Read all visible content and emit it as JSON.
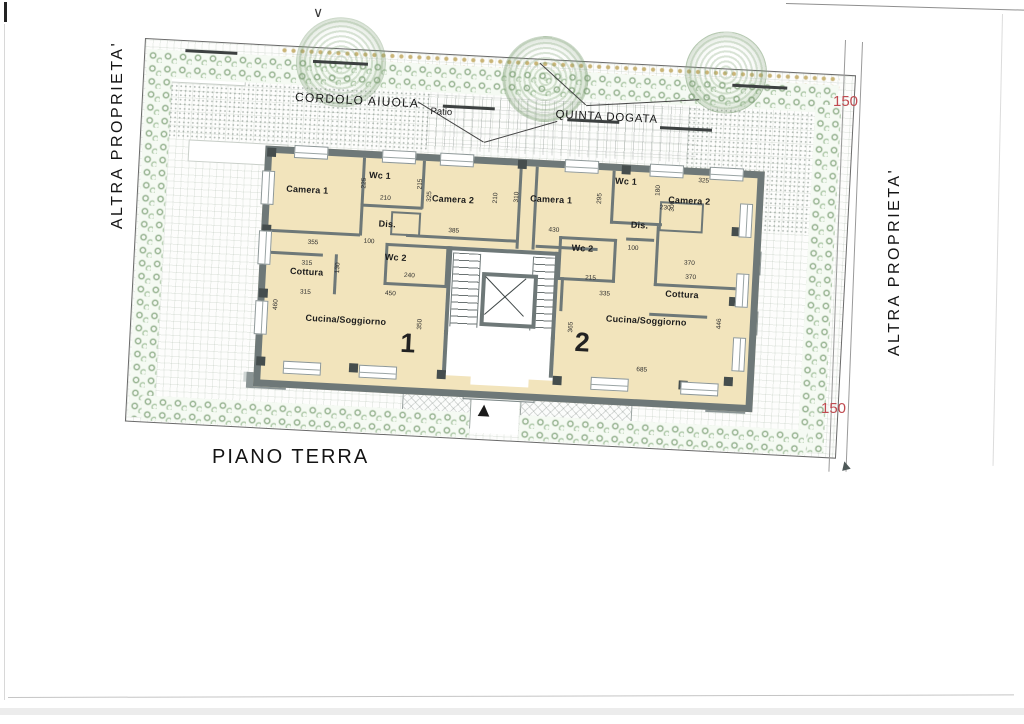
{
  "drawing_title": "PIANO TERRA",
  "site": {
    "left_property_label": "ALTRA PROPRIETA'",
    "right_property_label": "ALTRA PROPRIETA'",
    "flowerbed_label": "CORDOLO AIUOLA",
    "patio_label": "Patio",
    "hedge_label": "QUINTA DOGATA",
    "setback_dim_top": "150",
    "setback_dim_bottom": "150"
  },
  "building": {
    "apartment_numbers": [
      {
        "text": "1",
        "x": 138,
        "y": 168
      },
      {
        "text": "2",
        "x": 312,
        "y": 158
      }
    ],
    "room_labels": [
      {
        "text": "Camera 1",
        "x": 16,
        "y": 30
      },
      {
        "text": "Wc 1",
        "x": 98,
        "y": 12
      },
      {
        "text": "Camera 2",
        "x": 162,
        "y": 32
      },
      {
        "text": "Dis.",
        "x": 110,
        "y": 60
      },
      {
        "text": "Wc 2",
        "x": 118,
        "y": 93
      },
      {
        "text": "Cottura",
        "x": 24,
        "y": 112
      },
      {
        "text": "Cucina/Soggiorno",
        "x": 42,
        "y": 158
      },
      {
        "text": "Camera 1",
        "x": 260,
        "y": 27
      },
      {
        "text": "Wc 1",
        "x": 344,
        "y": 5
      },
      {
        "text": "Camera 2",
        "x": 398,
        "y": 21
      },
      {
        "text": "Dis.",
        "x": 362,
        "y": 48
      },
      {
        "text": "Wc 2",
        "x": 304,
        "y": 74
      },
      {
        "text": "Cottura",
        "x": 400,
        "y": 115
      },
      {
        "text": "Cucina/Soggiorno",
        "x": 342,
        "y": 143
      }
    ],
    "dimension_labels": [
      {
        "t": "355",
        "x": 40,
        "y": 84
      },
      {
        "t": "315",
        "x": 35,
        "y": 105
      },
      {
        "t": "315",
        "x": 35,
        "y": 134
      },
      {
        "t": "100",
        "x": 96,
        "y": 80
      },
      {
        "t": "240",
        "x": 138,
        "y": 112
      },
      {
        "t": "130",
        "x": 68,
        "y": 106,
        "v": 1
      },
      {
        "t": "210",
        "x": 110,
        "y": 36
      },
      {
        "t": "225",
        "x": 90,
        "y": 20,
        "v": 1
      },
      {
        "t": "215",
        "x": 146,
        "y": 18,
        "v": 1
      },
      {
        "t": "325",
        "x": 156,
        "y": 30,
        "v": 1
      },
      {
        "t": "385",
        "x": 180,
        "y": 65
      },
      {
        "t": "450",
        "x": 120,
        "y": 131
      },
      {
        "t": "460",
        "x": 8,
        "y": 146,
        "v": 1
      },
      {
        "t": "350",
        "x": 153,
        "y": 158,
        "v": 1
      },
      {
        "t": "210",
        "x": 222,
        "y": 28,
        "v": 1
      },
      {
        "t": "310",
        "x": 243,
        "y": 26,
        "v": 1
      },
      {
        "t": "430",
        "x": 280,
        "y": 59
      },
      {
        "t": "295",
        "x": 326,
        "y": 23,
        "v": 1
      },
      {
        "t": "230",
        "x": 390,
        "y": 31
      },
      {
        "t": "180",
        "x": 384,
        "y": 12,
        "v": 1
      },
      {
        "t": "325",
        "x": 427,
        "y": 2
      },
      {
        "t": "300",
        "x": 399,
        "y": 27,
        "v": 1
      },
      {
        "t": "100",
        "x": 360,
        "y": 73
      },
      {
        "t": "370",
        "x": 417,
        "y": 85
      },
      {
        "t": "370",
        "x": 419,
        "y": 99
      },
      {
        "t": "215",
        "x": 319,
        "y": 105
      },
      {
        "t": "335",
        "x": 334,
        "y": 120
      },
      {
        "t": "685",
        "x": 375,
        "y": 194
      },
      {
        "t": "446",
        "x": 452,
        "y": 142,
        "v": 1
      },
      {
        "t": "365",
        "x": 304,
        "y": 153,
        "v": 1
      }
    ]
  },
  "colors": {
    "wall_gray": "#6e7878",
    "floor_cream": "#f2e4bc",
    "shrub_green": "#5f9155",
    "flower_tan": "#c9b477",
    "dim_red": "#c04a50"
  }
}
